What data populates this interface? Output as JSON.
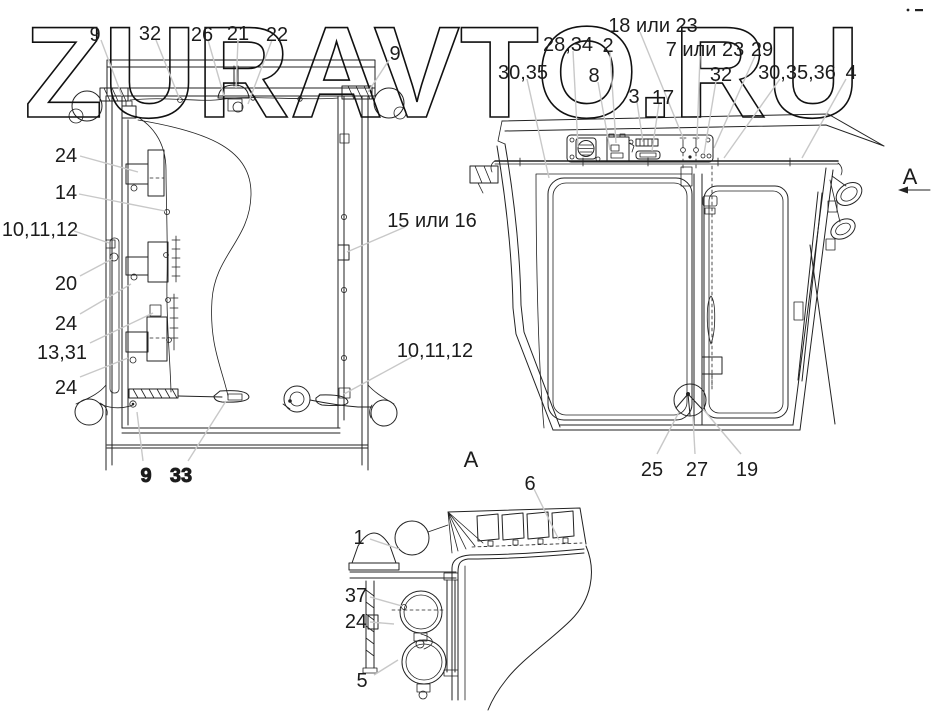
{
  "watermark": "ZURAVTO.RU",
  "palette": {
    "ink": "#222222",
    "leader": "#c8c8c8",
    "bg": "#ffffff",
    "wm": "#111111"
  },
  "markers": [
    {
      "text": "A",
      "x": 471,
      "y": 467,
      "role": "detail-view-title"
    },
    {
      "text": "A",
      "x": 910,
      "y": 184,
      "role": "view-direction-marker"
    }
  ],
  "labels": [
    {
      "text": "9",
      "x": 95,
      "y": 34,
      "leader": [
        101,
        40,
        122,
        96
      ]
    },
    {
      "text": "32",
      "x": 150,
      "y": 33,
      "leader": [
        156,
        40,
        180,
        100
      ]
    },
    {
      "text": "26",
      "x": 202,
      "y": 34,
      "leader": [
        208,
        40,
        224,
        96
      ]
    },
    {
      "text": "21",
      "x": 238,
      "y": 33,
      "leader": [
        238,
        40,
        236,
        88
      ]
    },
    {
      "text": "22",
      "x": 277,
      "y": 34,
      "leader": [
        272,
        40,
        248,
        104
      ]
    },
    {
      "text": "9",
      "x": 395,
      "y": 53,
      "leader": [
        389,
        60,
        368,
        92
      ]
    },
    {
      "text": "24",
      "x": 66,
      "y": 155,
      "leader": [
        80,
        156,
        138,
        172
      ]
    },
    {
      "text": "14",
      "x": 66,
      "y": 192,
      "leader": [
        79,
        194,
        165,
        211
      ]
    },
    {
      "text": "10,11,12",
      "x": 40,
      "y": 229,
      "leader": [
        74,
        231,
        109,
        243
      ]
    },
    {
      "text": "20",
      "x": 66,
      "y": 283,
      "leader": [
        80,
        276,
        112,
        259
      ]
    },
    {
      "text": "24",
      "x": 66,
      "y": 323,
      "leader": [
        80,
        314,
        131,
        284
      ]
    },
    {
      "text": "13,31",
      "x": 62,
      "y": 352,
      "leader": [
        90,
        343,
        153,
        313
      ]
    },
    {
      "text": "24",
      "x": 66,
      "y": 387,
      "leader": [
        80,
        377,
        128,
        358
      ]
    },
    {
      "text": "15 или 16",
      "x": 432,
      "y": 220,
      "leader": [
        405,
        227,
        347,
        252
      ]
    },
    {
      "text": "10,11,12",
      "x": 435,
      "y": 350,
      "leader": [
        412,
        357,
        344,
        394
      ]
    },
    {
      "text": "9",
      "x": 146,
      "y": 475,
      "leader": [
        143,
        461,
        137,
        412
      ],
      "dbl": true
    },
    {
      "text": "33",
      "x": 181,
      "y": 475,
      "leader": [
        188,
        461,
        226,
        401
      ],
      "dbl": true
    },
    {
      "text": "18 или 23",
      "x": 653,
      "y": 25,
      "leader": [
        640,
        32,
        684,
        140
      ]
    },
    {
      "text": "28,34",
      "x": 568,
      "y": 44,
      "leader": [
        573,
        51,
        578,
        147
      ]
    },
    {
      "text": "2",
      "x": 608,
      "y": 45,
      "leader": [
        610,
        52,
        616,
        143
      ]
    },
    {
      "text": "7 или 23",
      "x": 705,
      "y": 49,
      "leader": [
        700,
        56,
        697,
        140
      ]
    },
    {
      "text": "29",
      "x": 762,
      "y": 49,
      "leader": [
        755,
        56,
        714,
        148
      ]
    },
    {
      "text": "30,35",
      "x": 523,
      "y": 72,
      "leader": [
        527,
        79,
        549,
        178
      ]
    },
    {
      "text": "8",
      "x": 594,
      "y": 75,
      "leader": [
        598,
        82,
        610,
        150
      ]
    },
    {
      "text": "32",
      "x": 721,
      "y": 74,
      "leader": [
        716,
        81,
        704,
        154
      ]
    },
    {
      "text": "30,35,36",
      "x": 797,
      "y": 72,
      "leader": [
        780,
        79,
        724,
        158
      ]
    },
    {
      "text": "4",
      "x": 851,
      "y": 72,
      "leader": [
        846,
        79,
        802,
        158
      ]
    },
    {
      "text": "3",
      "x": 634,
      "y": 96,
      "leader": [
        637,
        102,
        643,
        142
      ]
    },
    {
      "text": "17",
      "x": 663,
      "y": 97,
      "leader": [
        659,
        103,
        652,
        151
      ]
    },
    {
      "text": "25",
      "x": 652,
      "y": 469,
      "leader": [
        657,
        454,
        679,
        412
      ]
    },
    {
      "text": "27",
      "x": 697,
      "y": 469,
      "leader": [
        695,
        454,
        693,
        417
      ]
    },
    {
      "text": "19",
      "x": 747,
      "y": 469,
      "leader": [
        741,
        454,
        703,
        409
      ]
    },
    {
      "text": "6",
      "x": 530,
      "y": 483,
      "leader": [
        534,
        489,
        559,
        540
      ]
    },
    {
      "text": "1",
      "x": 359,
      "y": 537,
      "leader": [
        370,
        539,
        399,
        549
      ]
    },
    {
      "text": "37",
      "x": 356,
      "y": 595,
      "leader": [
        370,
        597,
        402,
        606
      ]
    },
    {
      "text": "24",
      "x": 356,
      "y": 621,
      "leader": [
        370,
        622,
        394,
        624
      ]
    },
    {
      "text": "5",
      "x": 362,
      "y": 680,
      "leader": [
        374,
        675,
        398,
        660
      ]
    }
  ]
}
